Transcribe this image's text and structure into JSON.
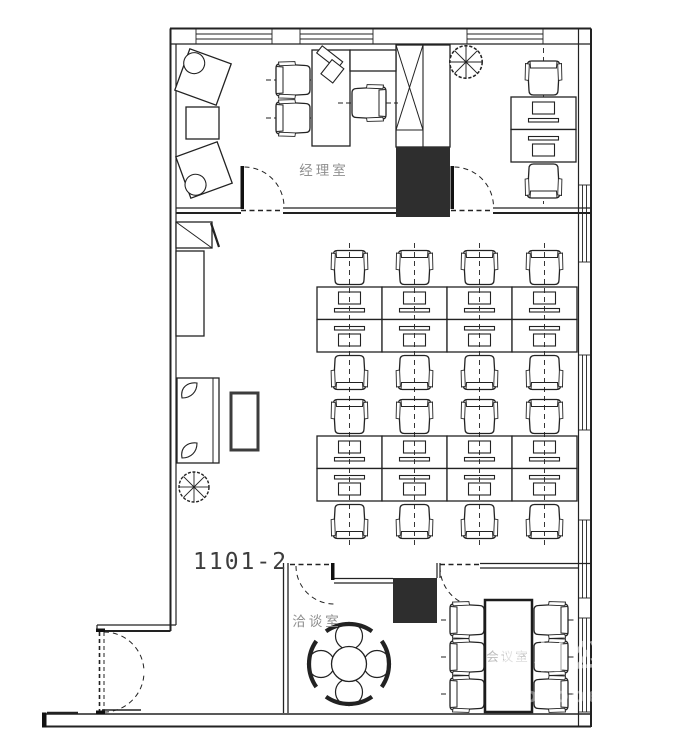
{
  "labels": {
    "unit_number": "1101-2",
    "manager_office": "经理室",
    "negotiation_room": "洽谈室",
    "conference_room": "会议室"
  },
  "watermark": {
    "line1": "素材公社",
    "line2": "tooopen.com"
  },
  "colors": {
    "background": "#ffffff",
    "line": "#222222",
    "room_label": "#8f8f8f",
    "faint_label": "#bdbdbd",
    "column_fill": "#2e2e2e",
    "unit_label": "#3d3d3d",
    "watermark": "#ffffff"
  },
  "plan_data": {
    "type": "office floor plan",
    "unit_number": "1101-2",
    "rooms": [
      {
        "id": "manager-office",
        "label": "经理室",
        "furniture": [
          "desk with angled monitor",
          "credenza",
          "executive chair",
          "2 guest chairs",
          "2 rotated lounge chairs",
          "side table",
          "wardrobe cabinet with X brace"
        ]
      },
      {
        "id": "staff-office-right",
        "label": "",
        "furniture": [
          "2 face-to-face workstations",
          "2 task chairs",
          "potted tree"
        ]
      },
      {
        "id": "open-office",
        "label": "",
        "furniture": [
          "16 workstations in 2 back-to-back banks (4 columns x 2 rows each)",
          "16 task chairs"
        ]
      },
      {
        "id": "lounge-area",
        "label": "",
        "furniture": [
          "sofa with 2 cushions",
          "coffee table",
          "storage cabinet",
          "shelf with diagonal brace",
          "potted tree"
        ]
      },
      {
        "id": "negotiation-room",
        "label": "洽谈室",
        "furniture": [
          "round table",
          "4 stools with curved seat backs"
        ]
      },
      {
        "id": "conference-room",
        "label": "会议室",
        "furniture": [
          "rectangular conference table",
          "6 chairs (3 per side)"
        ]
      }
    ],
    "structure": {
      "structural_columns": 2,
      "window_walls": [
        "top",
        "right"
      ],
      "entrance": "double swing door at lower left",
      "interior_doors": 4
    }
  }
}
